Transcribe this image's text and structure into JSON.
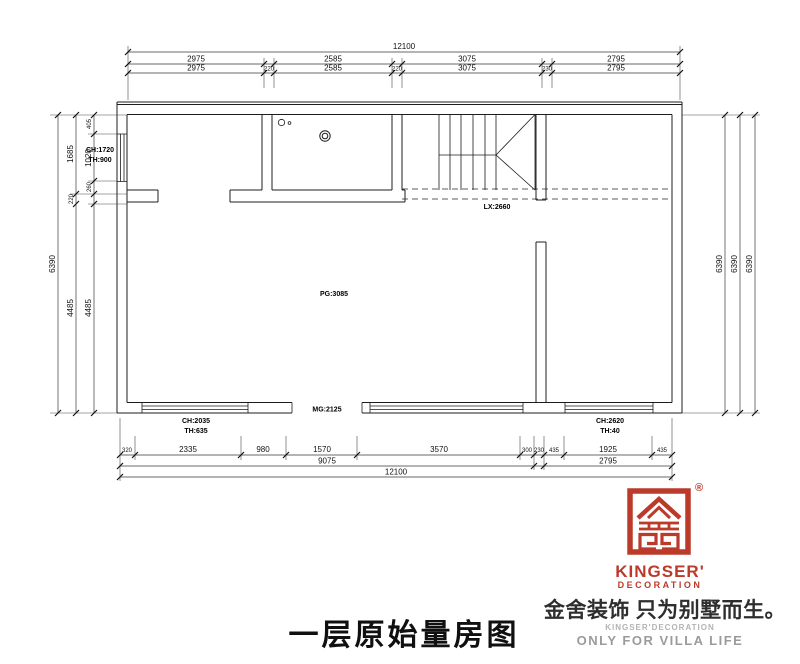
{
  "dims": {
    "top": {
      "total": "12100",
      "row2": [
        "2975",
        "2585",
        "3075",
        "2795"
      ],
      "row3": [
        "2975",
        "220",
        "2585",
        "220",
        "3075",
        "230",
        "2795"
      ]
    },
    "left": {
      "total": "6390",
      "mid": [
        "1685",
        "220",
        "4485"
      ],
      "inner": [
        "405",
        "1020",
        "260",
        "4485"
      ]
    },
    "right": {
      "totals": [
        "6390",
        "6390",
        "6390"
      ]
    },
    "bottom": {
      "row1": [
        "320",
        "2335",
        "980",
        "1570",
        "3570",
        "300",
        "230",
        "435",
        "1925",
        "435"
      ],
      "row2": [
        "9075",
        "2795"
      ],
      "total": "12100"
    }
  },
  "ann": {
    "window_left_ch": "CH:1720",
    "window_left_th": "TH:900",
    "beam": "LX:2660",
    "ceiling": "PG:3085",
    "door": "MG:2125",
    "window_bl_ch": "CH:2035",
    "window_bl_th": "TH:635",
    "window_br_ch": "CH:2620",
    "window_br_th": "TH:40"
  },
  "title": {
    "text": "一层原始量房图"
  },
  "logo": {
    "brand": "KINGSER'",
    "division": "DECORATION",
    "registered": "®",
    "tagline": "金舍装饰 只为别墅而生。",
    "sub_en": "KINGSER'DECORATION",
    "slogan": "ONLY FOR VILLA LIFE",
    "colors": {
      "red": "#bb3a2a",
      "gray": "#9b9b9b",
      "ink": "#1c1c1c"
    }
  }
}
